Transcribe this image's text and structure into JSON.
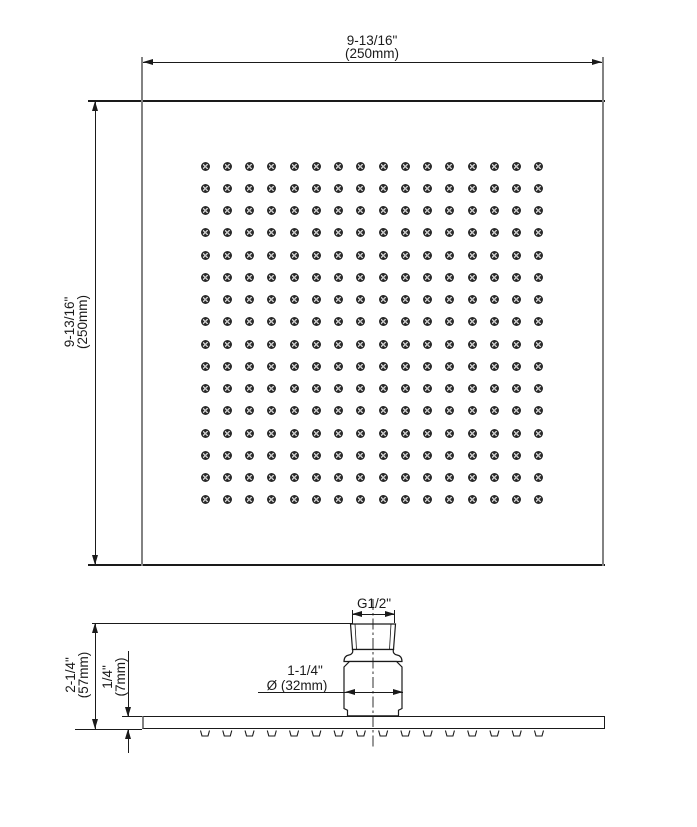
{
  "drawing": {
    "top_view": {
      "width_dimension": {
        "inches": "9-13/16\"",
        "metric": "(250mm)"
      },
      "height_dimension": {
        "inches": "9-13/16\"",
        "metric": "(250mm)"
      },
      "nozzle_grid": {
        "rows": 16,
        "columns": 16
      }
    },
    "side_view": {
      "thread_label": "G1/2\"",
      "overall_height_dimension": {
        "inches": "2-1/4\"",
        "metric": "(57mm)"
      },
      "plate_thickness_dimension": {
        "inches": "1/4\"",
        "metric": "(7mm)"
      },
      "connector_diameter_dimension": {
        "inches": "1-1/4\"",
        "metric": "Ø (32mm)"
      },
      "nozzle_count_side": 16
    },
    "colors": {
      "line": "#1a1a1a",
      "edge_shadow": "#828282",
      "nozzle_fill": "#2b2b2b",
      "background": "#ffffff"
    }
  }
}
